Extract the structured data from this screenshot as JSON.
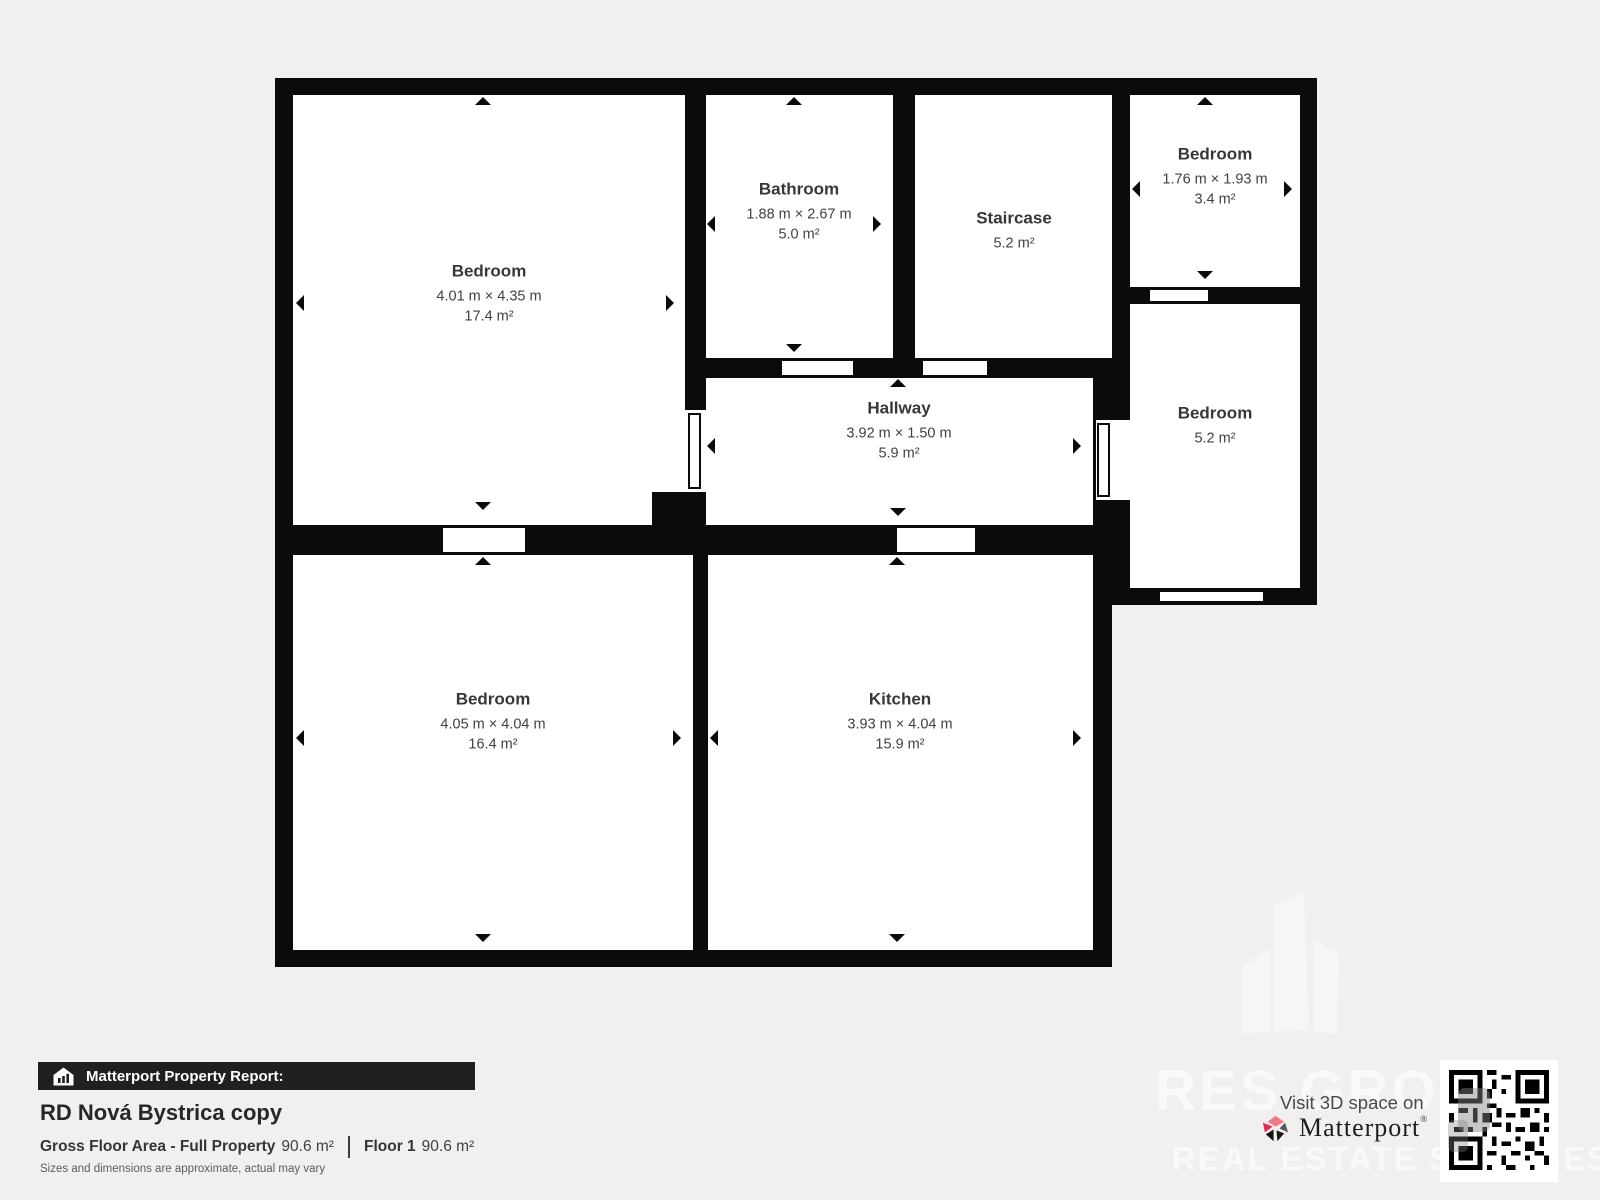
{
  "colors": {
    "background": "#f1f0ee",
    "wall": "#0b0b0b",
    "room": "#ffffff",
    "accent_pink": "#e62a53",
    "bar_background": "#221f20"
  },
  "plan": {
    "rooms": [
      {
        "name": "Bedroom",
        "dims": "4.01 m × 4.35 m",
        "area": "17.4 m²"
      },
      {
        "name": "Bathroom",
        "dims": "1.88 m × 2.67 m",
        "area": "5.0 m²"
      },
      {
        "name": "Staircase",
        "dims": "",
        "area": "5.2 m²"
      },
      {
        "name": "Bedroom",
        "dims": "1.76 m × 1.93 m",
        "area": "3.4 m²"
      },
      {
        "name": "Hallway",
        "dims": "3.92 m × 1.50 m",
        "area": "5.9 m²"
      },
      {
        "name": "Bedroom",
        "dims": "",
        "area": "5.2 m²"
      },
      {
        "name": "Bedroom",
        "dims": "4.05 m × 4.04 m",
        "area": "16.4 m²"
      },
      {
        "name": "Kitchen",
        "dims": "3.93 m × 4.04 m",
        "area": "15.9 m²"
      }
    ]
  },
  "report": {
    "bar_label": "Matterport Property Report:",
    "title": "RD Nová Bystrica copy",
    "gfa_label": "Gross Floor Area - Full Property",
    "gfa_value": "90.6 m²",
    "floor_label": "Floor 1",
    "floor_value": "90.6 m²",
    "disclaimer": "Sizes and dimensions are approximate, actual may vary"
  },
  "cta": {
    "visit_label": "Visit 3D space on",
    "brand": "Matterport",
    "trademark": "®"
  },
  "watermark": {
    "line1": "RES GROUP",
    "line2": "REAL ESTATE SERVICES"
  }
}
